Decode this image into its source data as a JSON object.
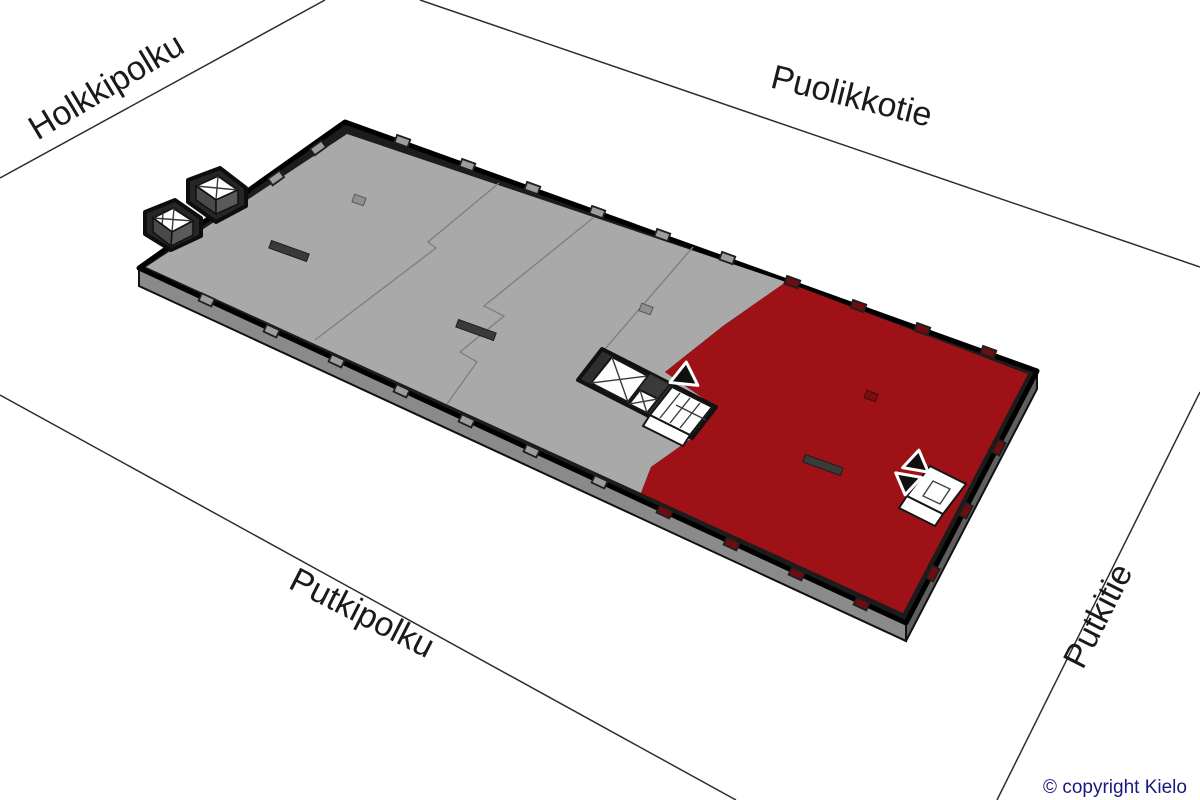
{
  "colors": {
    "background": "#FFFFFF",
    "available_area": "#9E1116",
    "available_column": "#7A0E11",
    "leased_area": "#A9A9A9",
    "building_outline": "#1C1C1C",
    "side_wall_sw": "#8A8A8A",
    "side_wall_se": "#5F5F5F",
    "street_line": "#2E2E2E",
    "street_label": "#1A1A1A",
    "copyright": "#1A1A7E"
  },
  "streets": {
    "holkkipolku": {
      "label": "Holkkipolku"
    },
    "puolikkotie": {
      "label": "Puolikkotie"
    },
    "putkipolku": {
      "label": "Putkipolku"
    },
    "putkitie": {
      "label": "Putkitie"
    }
  },
  "footer": {
    "copyright": "© copyright Kielo"
  }
}
